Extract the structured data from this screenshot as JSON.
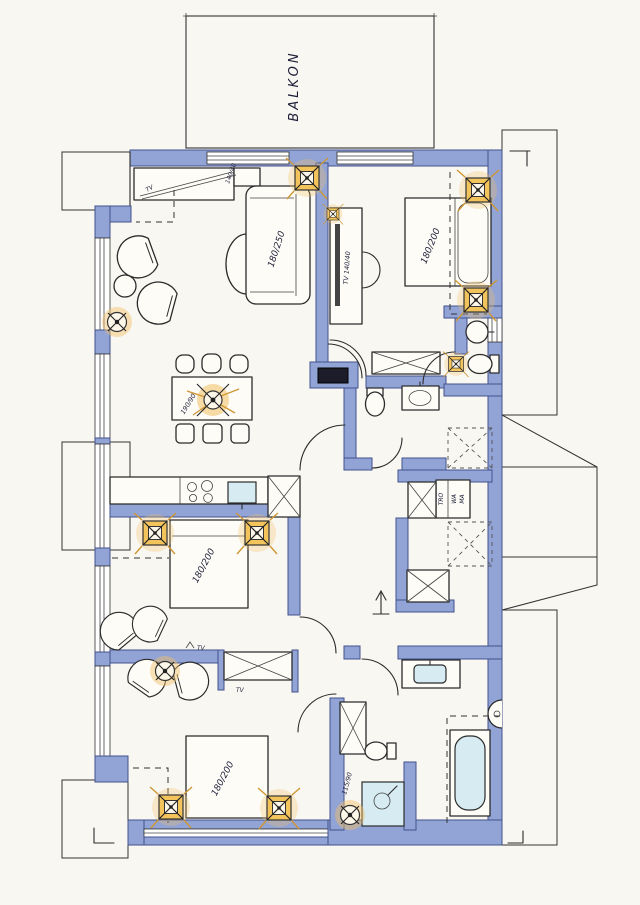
{
  "plan": {
    "type": "floor-plan-hand-drawn",
    "balcony_label": "BALKON",
    "living": {
      "sideboard_tv_label": "TV",
      "sideboard_size_label": "140/40",
      "sofa_label": "180/250",
      "dining_table_label": "190/90"
    },
    "bedroom_top_right": {
      "bed_label": "180/200",
      "tv_board_label": "TV 140/40"
    },
    "bedroom_middle_left": {
      "bed_label": "180/200"
    },
    "bedroom_bottom_left": {
      "bed_label": "180/200",
      "tv_cabinet_label": "TV",
      "tv_outlet_label": "TV"
    },
    "bathroom_bottom": {
      "shower_label": "115/90"
    },
    "utility": {
      "dryer_label": "TRO",
      "washer_label_1": "WA",
      "washer_label_2": "MA"
    },
    "colors": {
      "paper": "#f9f7f2",
      "wall_blue": "#92a4d6",
      "wall_edge": "#42528c",
      "fixture_blue": "#d6ecf2",
      "spotlight_orange": "#f3c35c",
      "ink": "#2b2b2b"
    }
  }
}
